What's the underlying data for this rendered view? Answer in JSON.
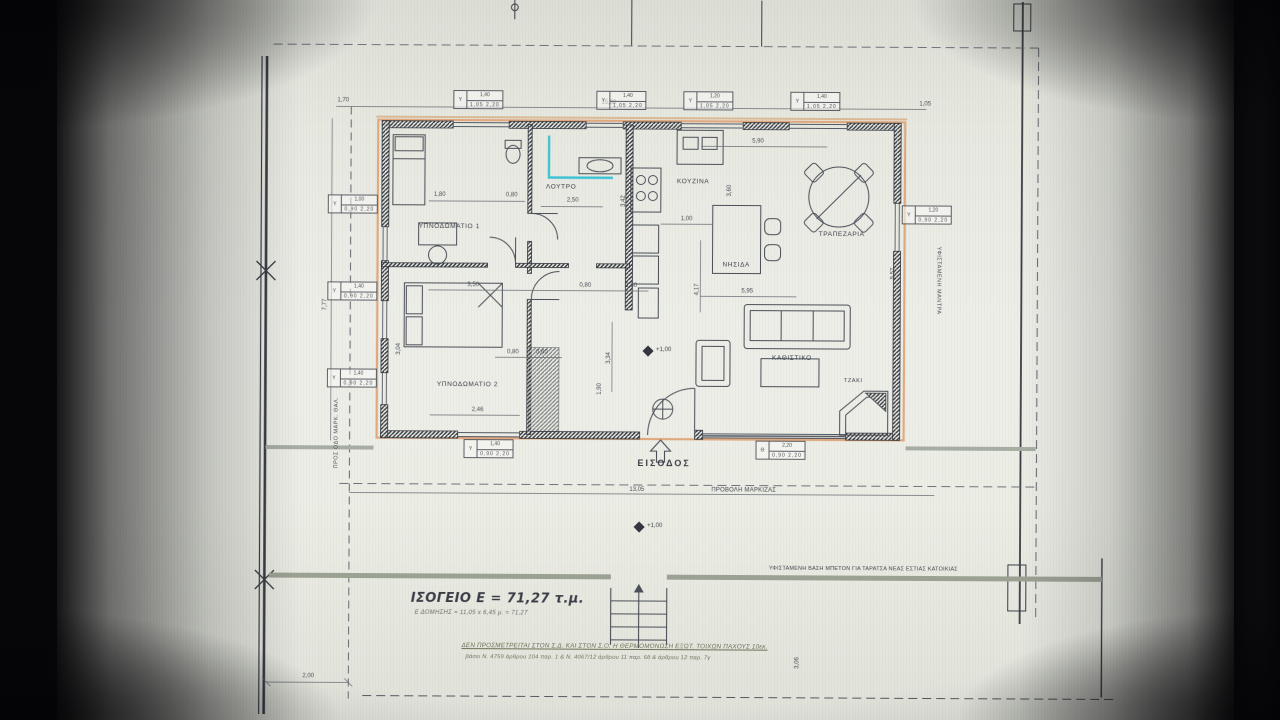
{
  "rooms": {
    "bedroom1": "ΥΠΝΟΔΩΜΑΤΙΟ 1",
    "bathroom": "ΛΟΥΤΡΟ",
    "kitchen": "ΚΟΥΖΙΝΑ",
    "dining": "ΤΡΑΠΕΖΑΡΙΑ",
    "island": "ΝΗΣΙΔΑ",
    "living": "ΚΑΘΙΣΤΙΚΟ",
    "fireplace": "ΤΖΑΚΙ",
    "bedroom2": "ΥΠΝΟΔΩΜΑΤΙΟ 2"
  },
  "annotations": {
    "entrance": "ΕΙΣΟΔΟΣ",
    "canopy": "ΠΡΟΒΟΛΗ ΜΑΡΚΙΖΑΣ",
    "level": "+1,00",
    "base_note": "ΥΦΙΣΤΑΜΕΝΗ ΒΑΣΗ ΜΠΕΤΟΝ ΓΙΑ ΤΑΡΑΤΣΑ ΝΕΑΣ ΕΣΤΙΑΣ ΚΑΤΟΙΚΙΑΣ",
    "left_boundary": "ΠΡΟΣ ΟΔΟ ΜΑΡΚ. ΘΑΛ.",
    "right_boundary": "ΥΦΙΣΤΑΜΕΝΗ ΜΑΝΤΡΑ"
  },
  "title_block": {
    "title": "ΙΣΟΓΕΙΟ Ε = 71,27 τ.μ.",
    "subtitle": "Ε ΔΟΜΗΣΗΣ = 11,05 x 6,45 μ. = 71,27",
    "note1": "ΔΕΝ ΠΡΟΣΜΕΤΡΕΙΤΑΙ ΣΤΟΝ Σ.Δ. ΚΑΙ ΣΤΟΝ Σ.Ο. Η ΘΕΡΜΟΜΟΝΩΣΗ ΕΞΩΤ. ΤΟΙΧΩΝ ΠΑΧΟΥΣ 10εκ.",
    "note2": "βάσει Ν. 4759 άρθρου 104 παρ. 1 & Ν. 4067/12 άρθρου 11 παρ. 6θ & άρθρου 12 παρ. 7γ"
  },
  "dims": [
    {
      "t": "1,70"
    },
    {
      "t": "15,98"
    },
    {
      "t": "1,05"
    },
    {
      "t": "1,80"
    },
    {
      "t": "0,80"
    },
    {
      "t": "2,50"
    },
    {
      "t": "3,50"
    },
    {
      "t": "0,80"
    },
    {
      "t": "1,30"
    },
    {
      "t": "1,00"
    },
    {
      "t": "5,90"
    },
    {
      "t": "5,95"
    },
    {
      "t": "2,46"
    },
    {
      "t": "0,80"
    },
    {
      "t": "0,60"
    },
    {
      "t": "13,05"
    },
    {
      "t": "2,00"
    },
    {
      "t": "7,77"
    },
    {
      "t": "3,04"
    },
    {
      "t": "3,34"
    },
    {
      "t": "1,90"
    },
    {
      "t": "3,42"
    },
    {
      "t": "4,17"
    },
    {
      "t": "3,60"
    },
    {
      "t": "5,57"
    },
    {
      "t": "3,06"
    }
  ],
  "tags": [
    {
      "letter": "Υ",
      "size": "1,40",
      "sill": "1,05 2,20"
    },
    {
      "letter": "Υ",
      "size": "1,40",
      "sill": "1,05 2,20"
    },
    {
      "letter": "Υ",
      "size": "1,20",
      "sill": "1,05 2,20"
    },
    {
      "letter": "Υ",
      "size": "1,40",
      "sill": "1,05 2,20"
    },
    {
      "letter": "Υ",
      "size": "1,00",
      "sill": "0,90 2,20"
    },
    {
      "letter": "Υ",
      "size": "1,40",
      "sill": "0,90 2,20"
    },
    {
      "letter": "Υ",
      "size": "1,40",
      "sill": "0,90 2,20"
    },
    {
      "letter": "Υ",
      "size": "1,40",
      "sill": "0,90 2,20"
    },
    {
      "letter": "Θ",
      "size": "2,20",
      "sill": "0,90 2,20"
    },
    {
      "letter": "Υ",
      "size": "1,20",
      "sill": "0,90 2,20"
    }
  ],
  "colors": {
    "highlight": "#dfa87e",
    "accent_cyan": "#3fc3d4"
  }
}
